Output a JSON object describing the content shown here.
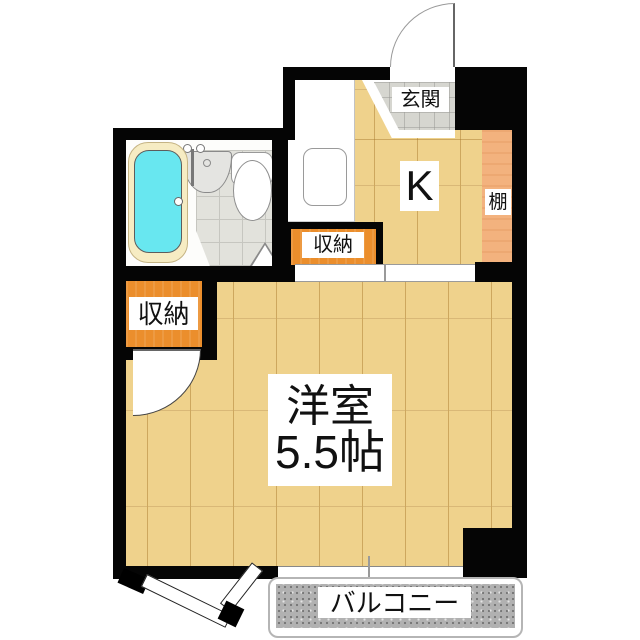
{
  "plan": {
    "type": "apartment-floor-plan",
    "labels": {
      "entrance": "玄関",
      "kitchen": "K",
      "shelf": "棚",
      "storage_upper": "収納",
      "storage_lower": "収納",
      "room_name": "洋室",
      "room_size": "5.5帖",
      "balcony": "バルコニー"
    },
    "colors": {
      "wall": "#050505",
      "wood": "#efd28c",
      "wood-line-a": "#cda75e",
      "wood-line-b": "#d9b877",
      "shelf": "#f3b27e",
      "storage": "#eb8e2c",
      "bathtub": "#68e7f0",
      "tub-rim": "#f6ecc3",
      "tile": "#e2e2dc",
      "tile-line": "#c6c6c0",
      "entrance-tile": "#d6d6d0",
      "balcony": "#b1b1b1",
      "label-bg": "#ffffff",
      "text": "#111111"
    }
  }
}
